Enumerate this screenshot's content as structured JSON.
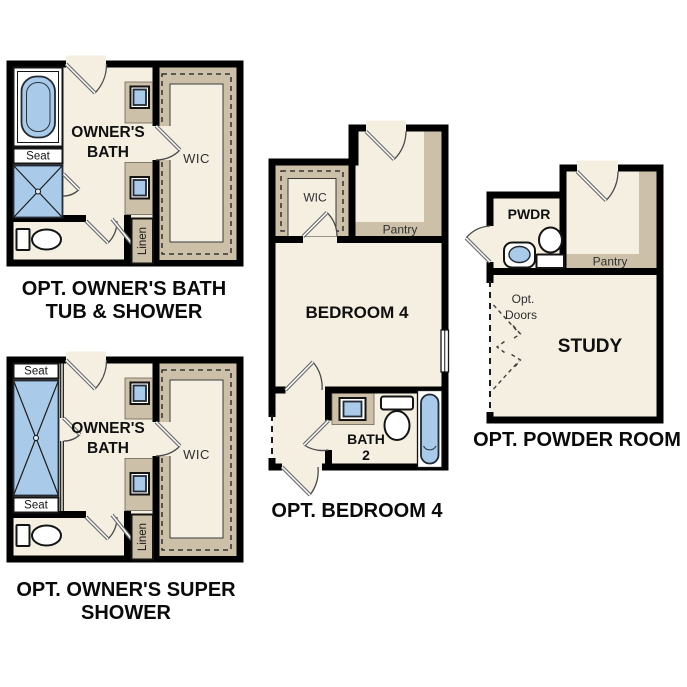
{
  "colors": {
    "wall": "#000000",
    "floor": "#f5efe2",
    "tan": "#cdc0a8",
    "blue": "#a9cbe9"
  },
  "plans": {
    "p1": {
      "caption1": "OPT. OWNER'S BATH",
      "caption2": "TUB & SHOWER",
      "room1": "OWNER'S",
      "room2": "BATH",
      "seat": "Seat",
      "wic": "WIC",
      "linen": "Linen"
    },
    "p2": {
      "caption1": "OPT. OWNER'S SUPER",
      "caption2": "SHOWER",
      "room1": "OWNER'S",
      "room2": "BATH",
      "seat_top": "Seat",
      "seat_bottom": "Seat",
      "wic": "WIC",
      "linen": "Linen"
    },
    "p3": {
      "caption": "OPT. BEDROOM 4",
      "room": "BEDROOM 4",
      "wic": "WIC",
      "pantry": "Pantry",
      "bath_line1": "BATH",
      "bath_line2": "2"
    },
    "p4": {
      "caption": "OPT. POWDER ROOM",
      "room": "STUDY",
      "pwdr": "PWDR",
      "pantry": "Pantry",
      "opt_doors_line1": "Opt.",
      "opt_doors_line2": "Doors"
    }
  }
}
